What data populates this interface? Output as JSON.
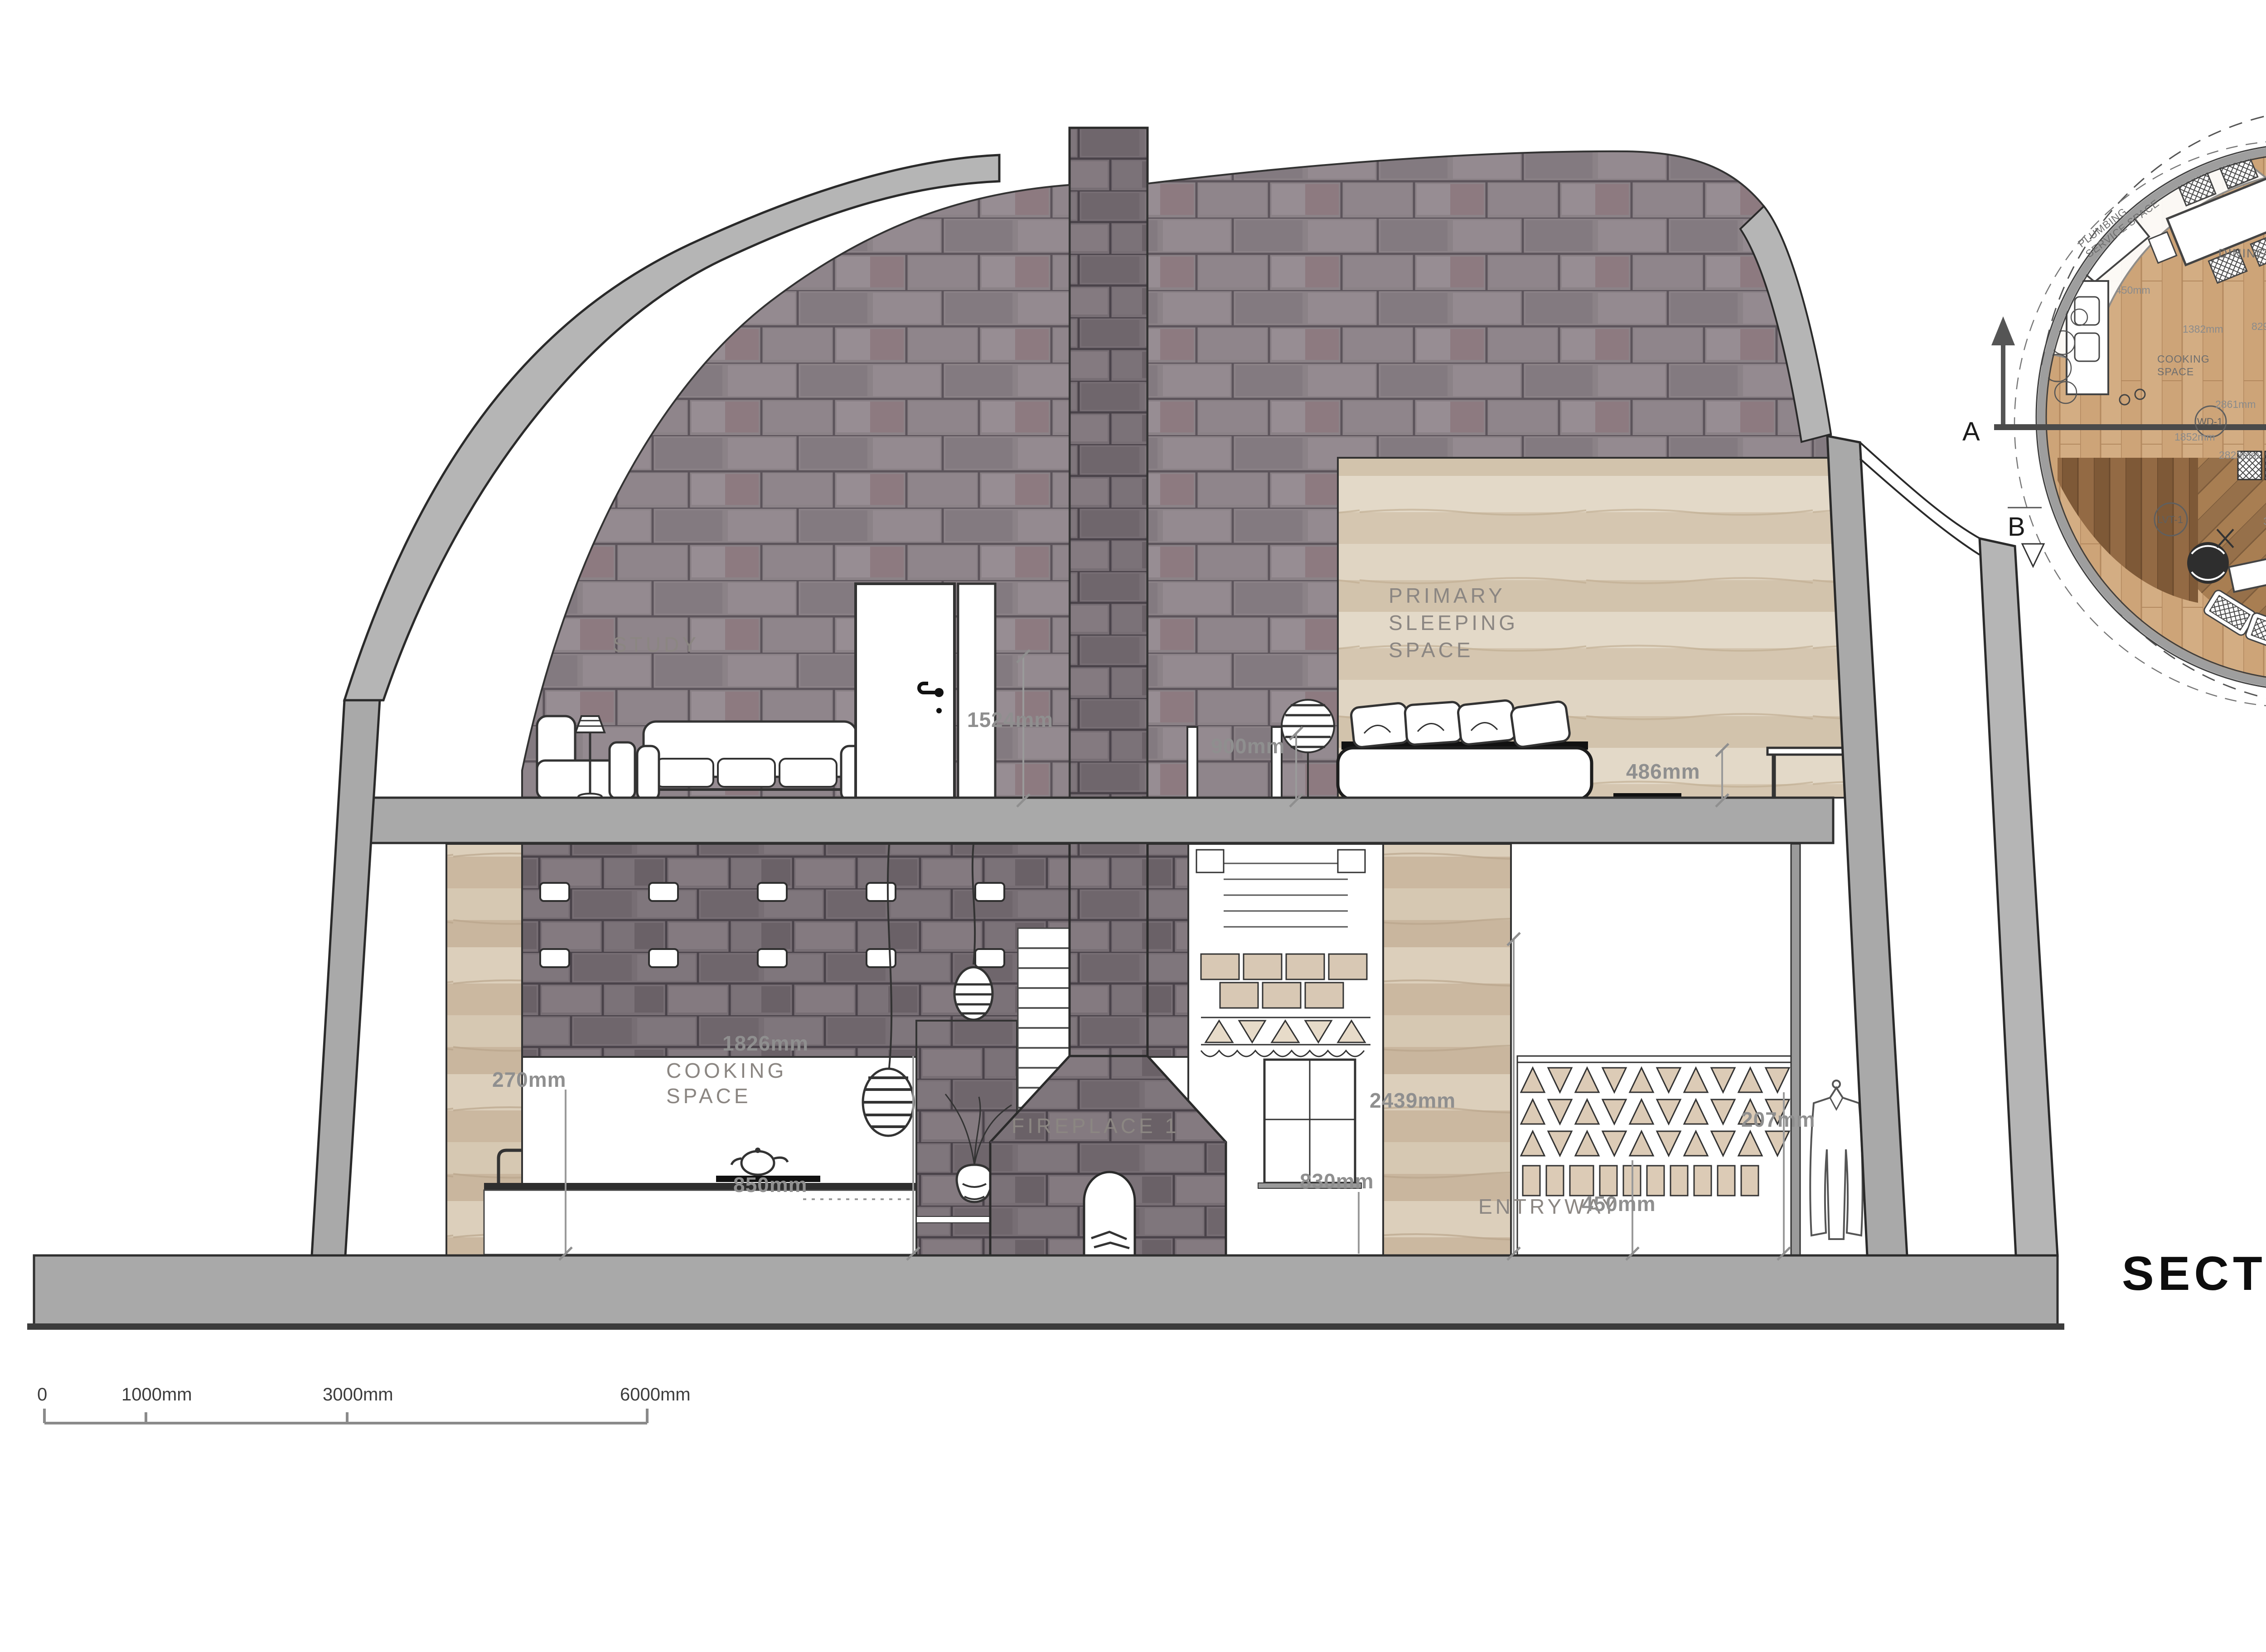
{
  "section": {
    "title": "SECTION",
    "labels": {
      "study": "STUDY",
      "primary_sleeping": [
        "PRIMARY",
        "SLEEPING",
        "SPACE"
      ],
      "cooking": [
        "COOKING",
        "SPACE"
      ],
      "fireplace": "FIREPLACE 1",
      "entryway": "ENTRYWAY"
    },
    "dims": {
      "study_wall": "1524mm",
      "stair_opening": "900mm",
      "side_table": "486mm",
      "pendant_drop": "1826mm",
      "left_wall": "270mm",
      "counter_height": "850mm",
      "window": "830mm",
      "earth_wall": "2439mm",
      "screen_base": "450mm",
      "coat_rail": "207mm"
    },
    "scale_bar": [
      "0",
      "1000mm",
      "3000mm",
      "6000mm"
    ]
  },
  "plan": {
    "rooms": {
      "plumbing": [
        "PLUMBING",
        "SERVICE SPACE"
      ],
      "dining": "DINING SPACE",
      "washroom": "WASHROOM",
      "storage": "STORAGE",
      "handcraft": "HANDCRAFT ROOM",
      "cooking": [
        "COOKING",
        "SPACE"
      ],
      "fireplace": "FIREPLACE 1",
      "up": "UP",
      "entryway": "ENTRYWAY",
      "closet": "CLOSET",
      "living": [
        "LIVING ROOM /",
        "PERFORMANCE SPACE"
      ],
      "outdoor": [
        "OUTDOOR/",
        "SEMI PRIVATE",
        "SITTING+",
        "GREETING",
        "SPACE"
      ],
      "open_above": [
        "OPEN TO",
        "ABOVE"
      ],
      "deck": [
        "DECK ON",
        "GROUND FLOOR"
      ]
    },
    "tags": {
      "lvt1": "LVT-1",
      "lvt2": "LVT-2",
      "lam1": "LAM-1",
      "dr1": "DR-1",
      "dr2": "DR-2",
      "wd1": "WD-1",
      "wd2": "WD-2"
    },
    "markers": {
      "a": "A",
      "a_prime": "A'",
      "b": "B",
      "b_prime": "B'"
    },
    "dims": {
      "d1042": "1042mm",
      "d450": "450mm",
      "d1382": "1382mm",
      "d829": "829mm",
      "d1291a": "1291mm",
      "d1320": "1320mm",
      "d998": "998mm",
      "d502a": "502mm",
      "d502b": "502mm",
      "d2861": "2861mm",
      "d1291b": "1291mm",
      "d916": "916mm",
      "d1852": "1852mm",
      "d1016": "1016mm",
      "d2823": "2823mm",
      "d3850": "3850mm",
      "d900": "900mm",
      "d3443": "3443mm"
    },
    "scale_bar": [
      "0",
      "1000mm",
      "3000mm",
      "6000mm"
    ]
  },
  "colors": {
    "slab": "#a9a9a9",
    "stone": "#8b8287",
    "stone_dark": "#776e74",
    "earth": "#d0c0aa",
    "dim_text": "#8f8f8f",
    "title_text": "#0d0d0d"
  }
}
